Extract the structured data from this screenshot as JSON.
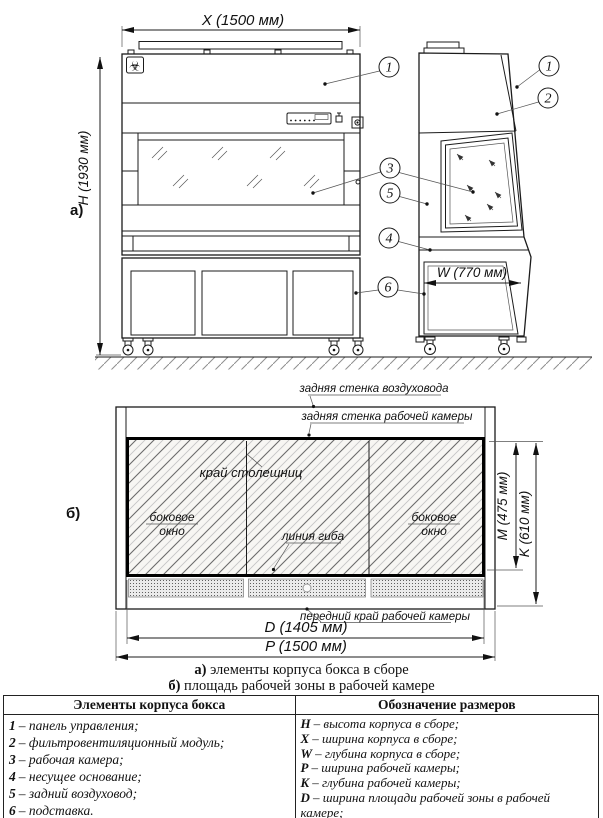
{
  "drawing": {
    "view_a_label": "а)",
    "view_b_label": "б)",
    "dim_x": "X (1500 мм)",
    "dim_h": "H (1930 мм)",
    "dim_w": "W (770 мм)",
    "dim_d": "D (1405 мм)",
    "dim_p": "P (1500 мм)",
    "dim_m": "M (475 мм)",
    "dim_k": "K (610 мм)",
    "biohazard_glyph": "☣",
    "callouts": {
      "c1": "1",
      "c2": "2",
      "c3": "3",
      "c4": "4",
      "c5": "5",
      "c6": "6"
    },
    "plan_labels": {
      "duct_back_wall": "задняя стенка воздуховода",
      "chamber_back_wall": "задняя стенка рабочей камеры",
      "tabletop_edge": "край столешниц",
      "bend_line": "линия гиба",
      "side_window_line1": "боковое",
      "side_window_line2": "окно",
      "chamber_front_edge": "передний край рабочей камеры"
    }
  },
  "captions": {
    "a_prefix": "а)",
    "a_text": " элементы корпуса бокса в сборе",
    "b_prefix": "б)",
    "b_text": " площадь рабочей зоны в рабочей камере"
  },
  "table": {
    "left_header": "Элементы корпуса бокса",
    "right_header": "Обозначение размеров",
    "elements": [
      {
        "n": "1",
        "t": "– панель управления;"
      },
      {
        "n": "2",
        "t": "– фильтровентиляционный модуль;"
      },
      {
        "n": "3",
        "t": "– рабочая камера;"
      },
      {
        "n": "4",
        "t": "– несущее основание;"
      },
      {
        "n": "5",
        "t": "– задний воздуховод;"
      },
      {
        "n": "6",
        "t": "– подставка."
      }
    ],
    "sizes": [
      {
        "n": "H",
        "t": "– высота корпуса в сборе;"
      },
      {
        "n": "X",
        "t": "– ширина корпуса в сборе;"
      },
      {
        "n": "W",
        "t": "– глубина корпуса в сборе;"
      },
      {
        "n": "P",
        "t": "– ширина рабочей камеры;"
      },
      {
        "n": "K",
        "t": "– глубина рабочей камеры;"
      },
      {
        "n": "D",
        "t": "– ширина площади рабочей зоны в рабочей камере;"
      },
      {
        "n": "M",
        "t": "– глубина площади рабочей зоны в рабочей камере рабочей камере."
      }
    ]
  }
}
